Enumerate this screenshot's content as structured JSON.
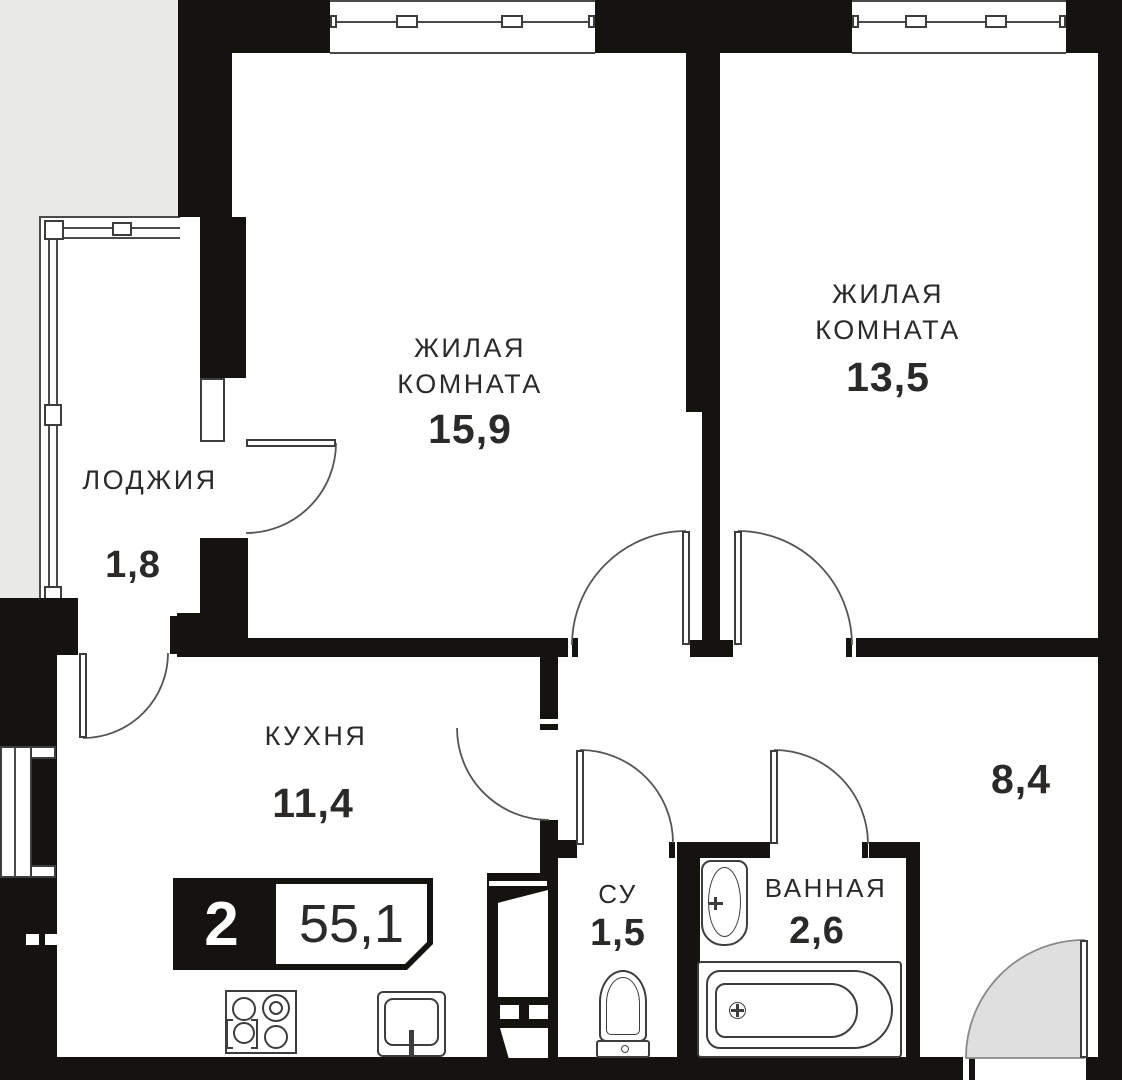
{
  "plan": {
    "type": "apartment-floor-plan",
    "badge": {
      "rooms_count": "2",
      "total_area": "55,1"
    },
    "rooms": [
      {
        "id": "living-1",
        "name_line1": "ЖИЛАЯ",
        "name_line2": "КОМНАТА",
        "area": "15,9"
      },
      {
        "id": "living-2",
        "name_line1": "ЖИЛАЯ",
        "name_line2": "КОМНАТА",
        "area": "13,5"
      },
      {
        "id": "loggia",
        "name_line1": "ЛОДЖИЯ",
        "area": "1,8"
      },
      {
        "id": "kitchen",
        "name_line1": "КУХНЯ",
        "area": "11,4"
      },
      {
        "id": "wc",
        "name_line1": "СУ",
        "area": "1,5"
      },
      {
        "id": "bathroom",
        "name_line1": "ВАННАЯ",
        "area": "2,6"
      },
      {
        "id": "hallway",
        "area": "8,4"
      }
    ],
    "colors": {
      "wall": "#151310",
      "thin_line": "#3d3d3d",
      "text": "#2b2a29",
      "outside": "#e9e9e8",
      "door_fill": "#dfdfdf"
    }
  }
}
